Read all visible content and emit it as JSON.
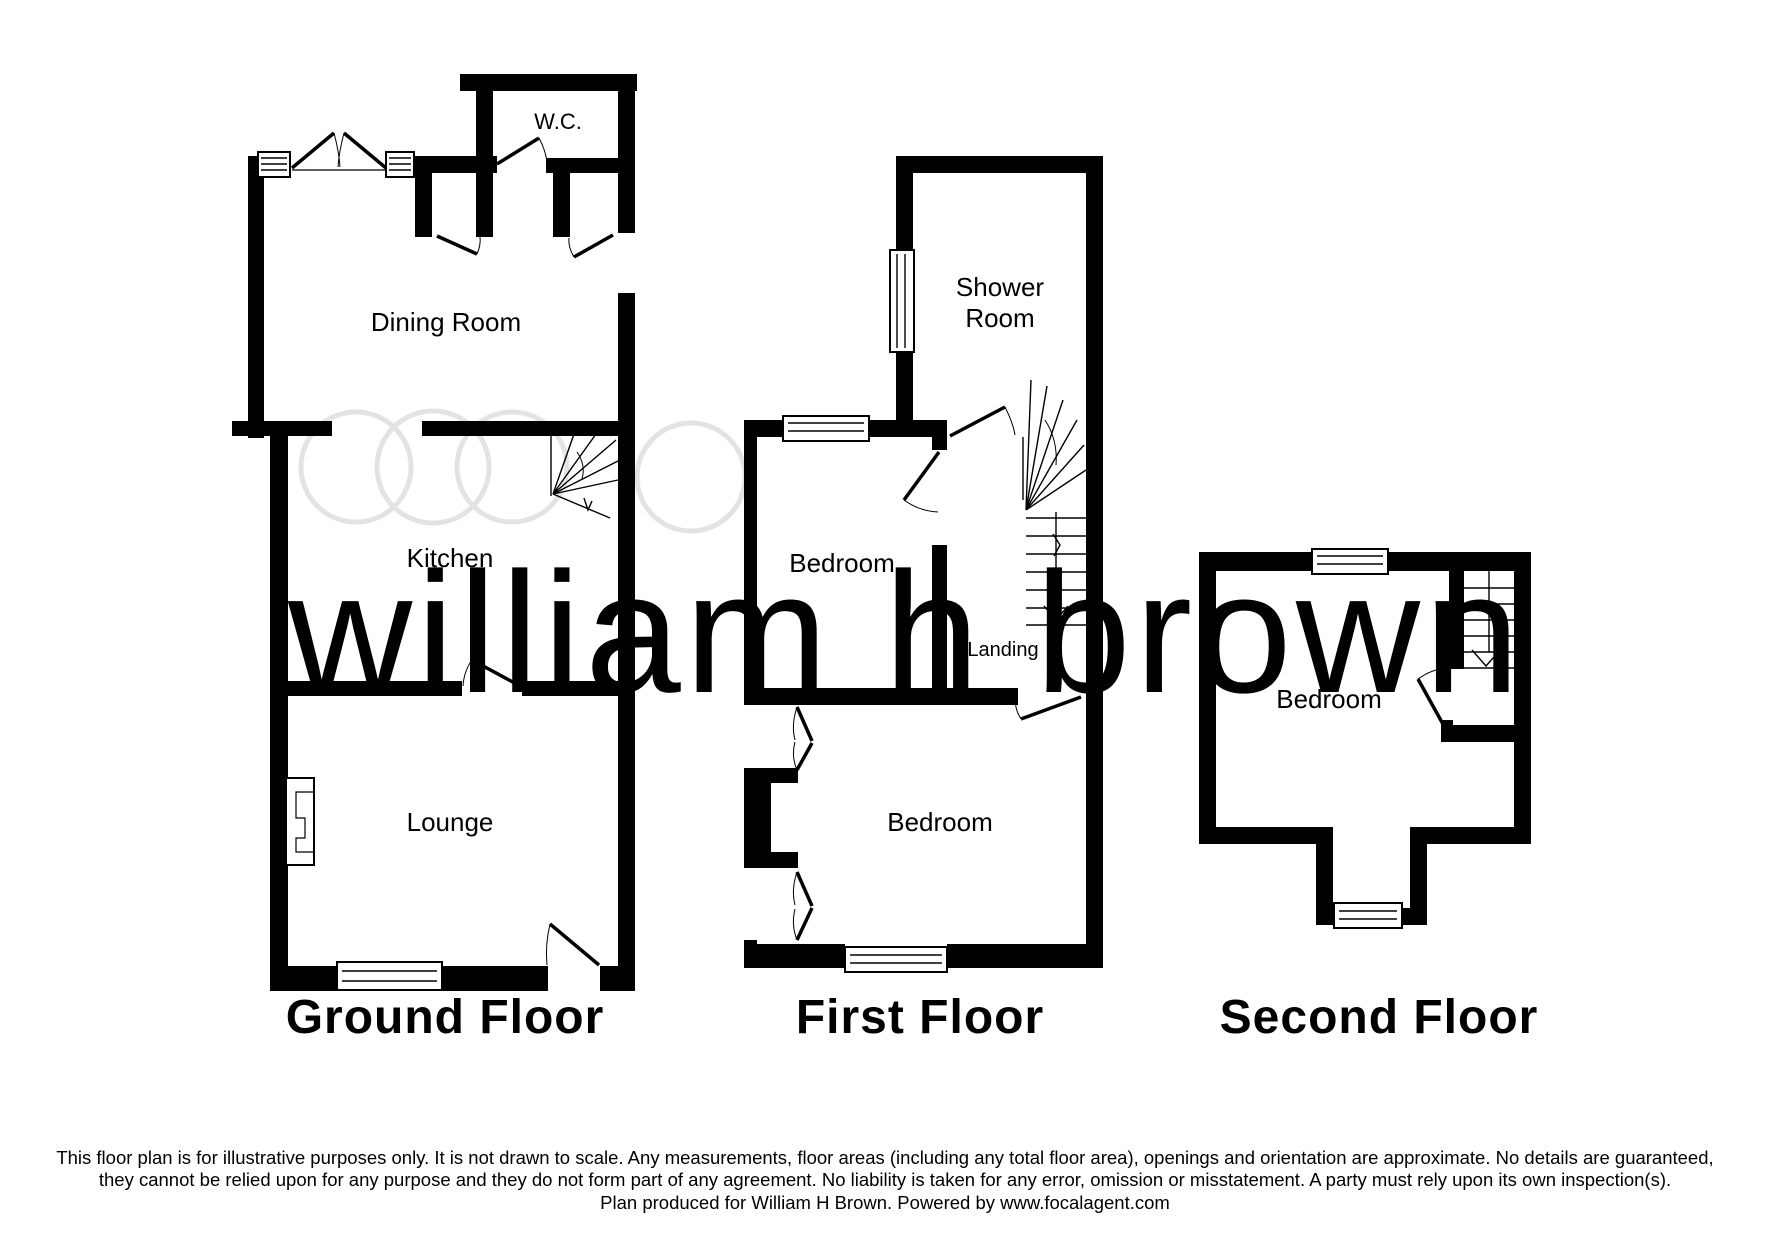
{
  "watermark": {
    "text": "william h brown",
    "logo": "three-overlapping-circles-plus-one"
  },
  "floors": {
    "ground": {
      "title": "Ground Floor",
      "wc": "W.C.",
      "dining": "Dining Room",
      "kitchen": "Kitchen",
      "lounge": "Lounge"
    },
    "first": {
      "title": "First Floor",
      "shower_line1": "Shower",
      "shower_line2": "Room",
      "bedroom_front": "Bedroom",
      "landing": "Landing",
      "bedroom_rear": "Bedroom"
    },
    "second": {
      "title": "Second Floor",
      "bedroom": "Bedroom"
    }
  },
  "disclaimer": {
    "line1": "This floor plan is for illustrative purposes only. It is not drawn to scale. Any measurements, floor areas (including any total floor area), openings and orientation are approximate. No details are guaranteed,",
    "line2": "they cannot be relied upon for any purpose and they do not form part of any agreement. No liability is taken for any error, omission or misstatement. A party must rely upon its own inspection(s).",
    "line3": "Plan produced for William H Brown. Powered by www.focalagent.com"
  },
  "colors": {
    "wall": "#000000",
    "watermark_text": "#ebebeb",
    "watermark_circle": "#e3e3e3",
    "text": "#000000"
  }
}
